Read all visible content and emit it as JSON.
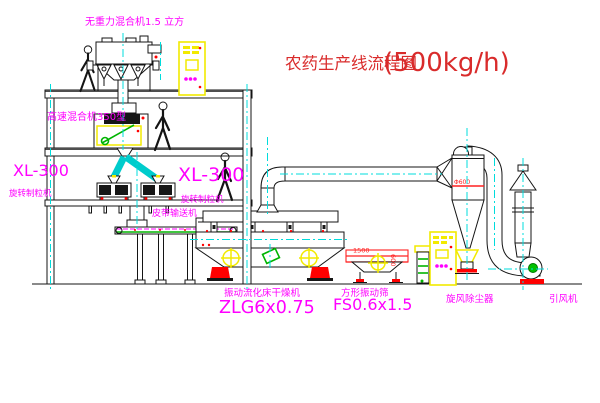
{
  "title": {
    "text": "农药生产线流程图",
    "capacity": "(500kg/h)"
  },
  "labels": {
    "gravity_free_mixer": "无重力混合机1.5 立方",
    "high_speed_mixer": "高速混合机350型",
    "granulator_left_model": "XL-300",
    "granulator_left_name": "旋转制粒机",
    "granulator_right_model": "XL-300",
    "granulator_right_name": "旋转制粒机",
    "belt_conveyor": "皮带输送机",
    "fluid_bed_dryer_name": "振动流化床干燥机",
    "fluid_bed_dryer_model": "ZLG6x0.75",
    "square_screen_name": "方形振动筛",
    "square_screen_model": "FS0.6x1.5",
    "cyclone_collector": "旋风除尘器",
    "induced_draft_fan": "引风机"
  },
  "dims": {
    "screen_length": "1500",
    "screen_width": "600",
    "cyclone_diameter": "Φ600"
  },
  "colors": {
    "label_magenta": "#ff00ff",
    "title_red": "#d92b2b",
    "line_black": "#141414",
    "centerline_cyan": "#00dcdc",
    "cabinet_yellow": "#f2ea00",
    "accent_red": "#ff0000",
    "accent_green": "#00b400",
    "background": "#ffffff"
  }
}
